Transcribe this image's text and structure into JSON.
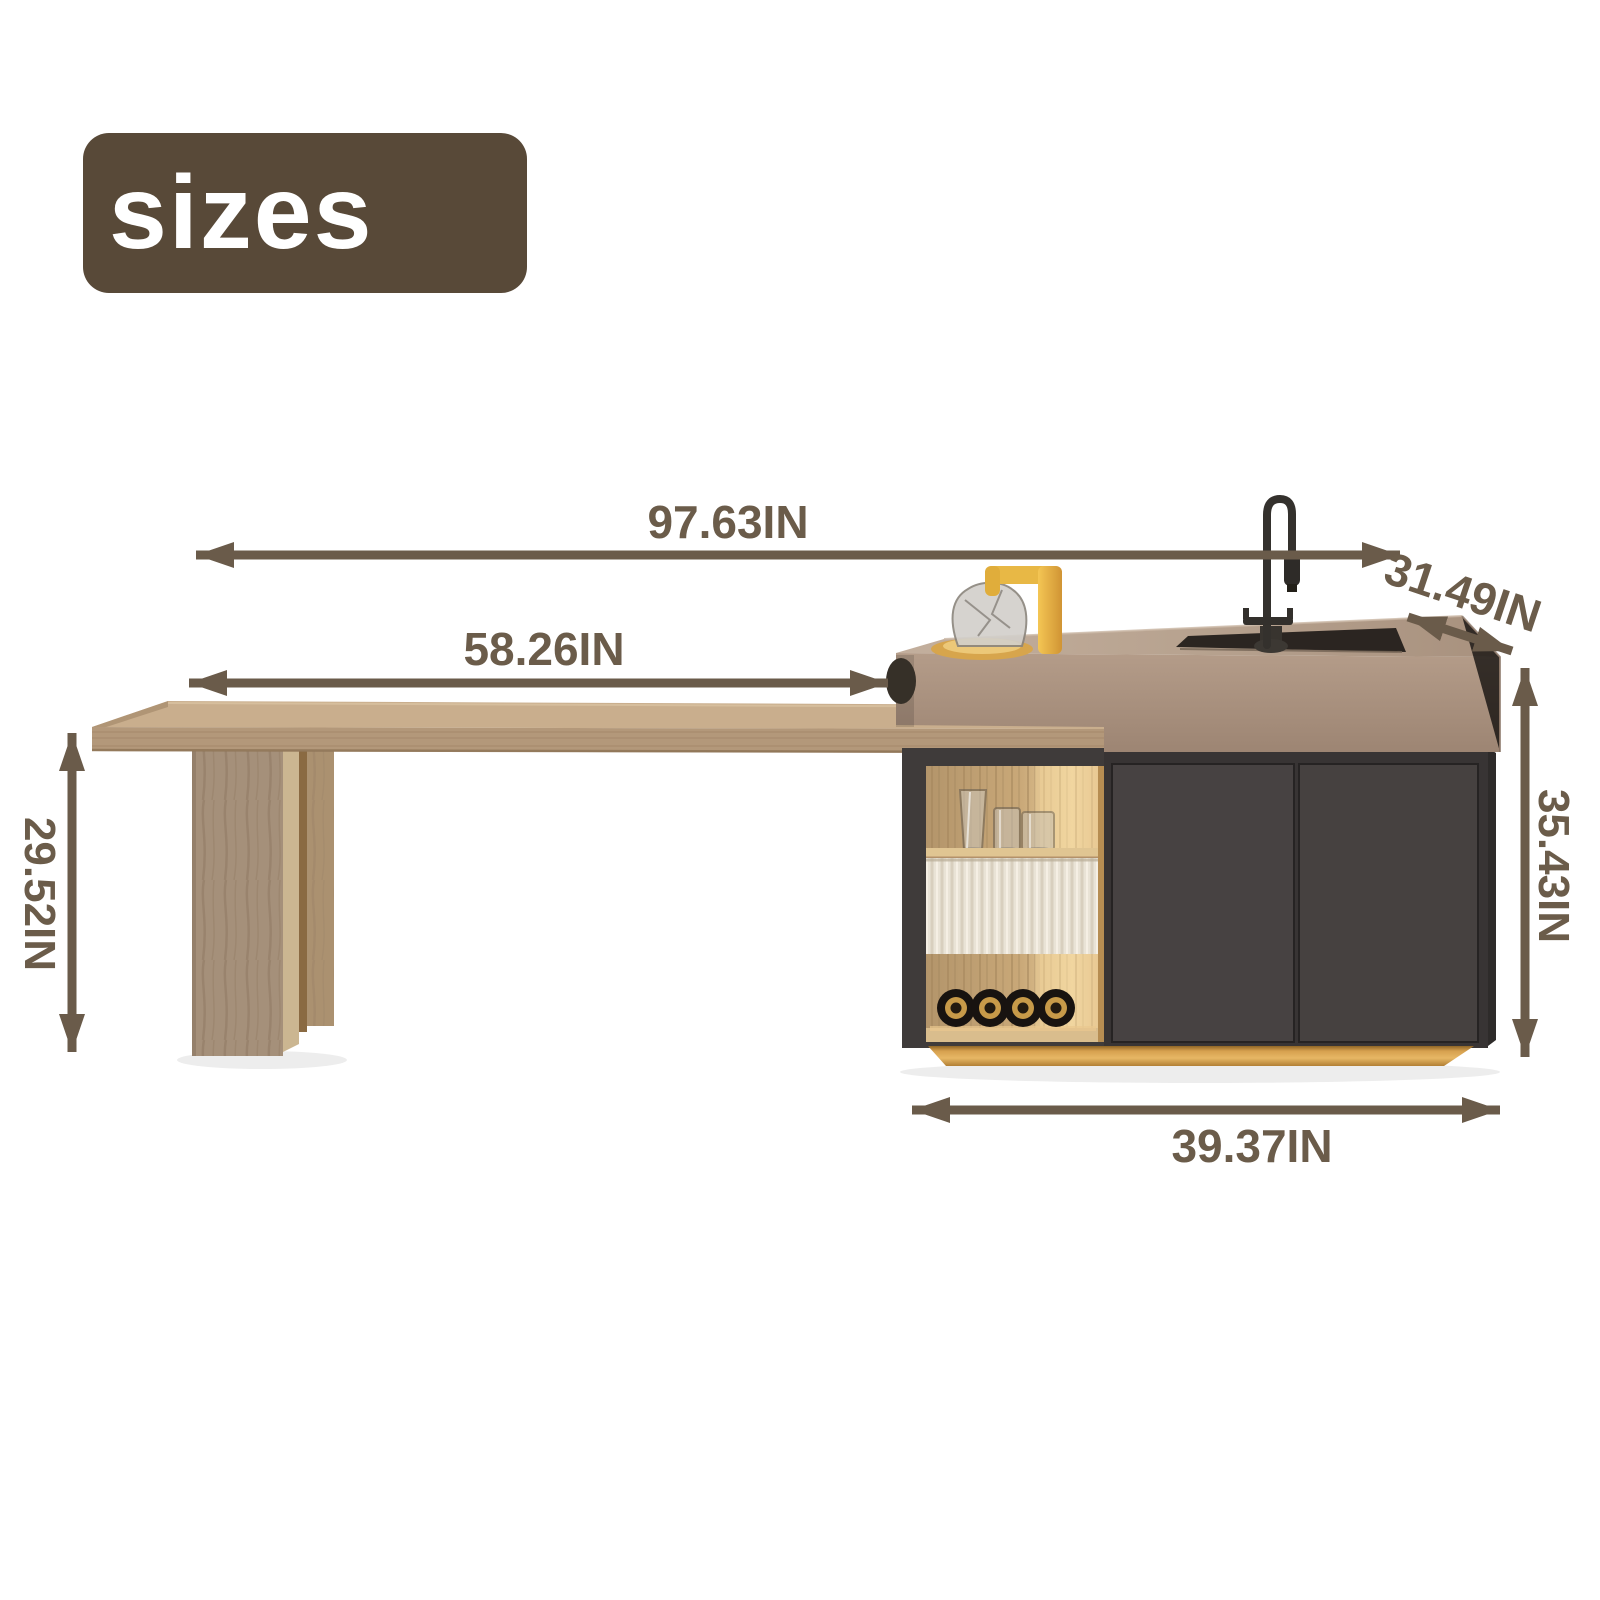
{
  "title_badge": {
    "label": "sizes"
  },
  "dimension_labels": {
    "overall_width": "97.63IN",
    "tabletop_length": "58.26IN",
    "counter_depth": "31.49IN",
    "table_height": "29.52IN",
    "island_height": "35.43IN",
    "island_base_width": "39.37IN"
  },
  "palette": {
    "annotation_brown": "#6a5b4a",
    "badge_brown": "#584938",
    "badge_text": "#ffffff",
    "wood_light": "#c9ae8d",
    "wood_mid": "#a5907a",
    "counter_taupe": "#a98f7d",
    "cabinet_charcoal": "#454140",
    "brass_gold": "#d6a04e",
    "accent_yellow": "#eebc4a"
  }
}
